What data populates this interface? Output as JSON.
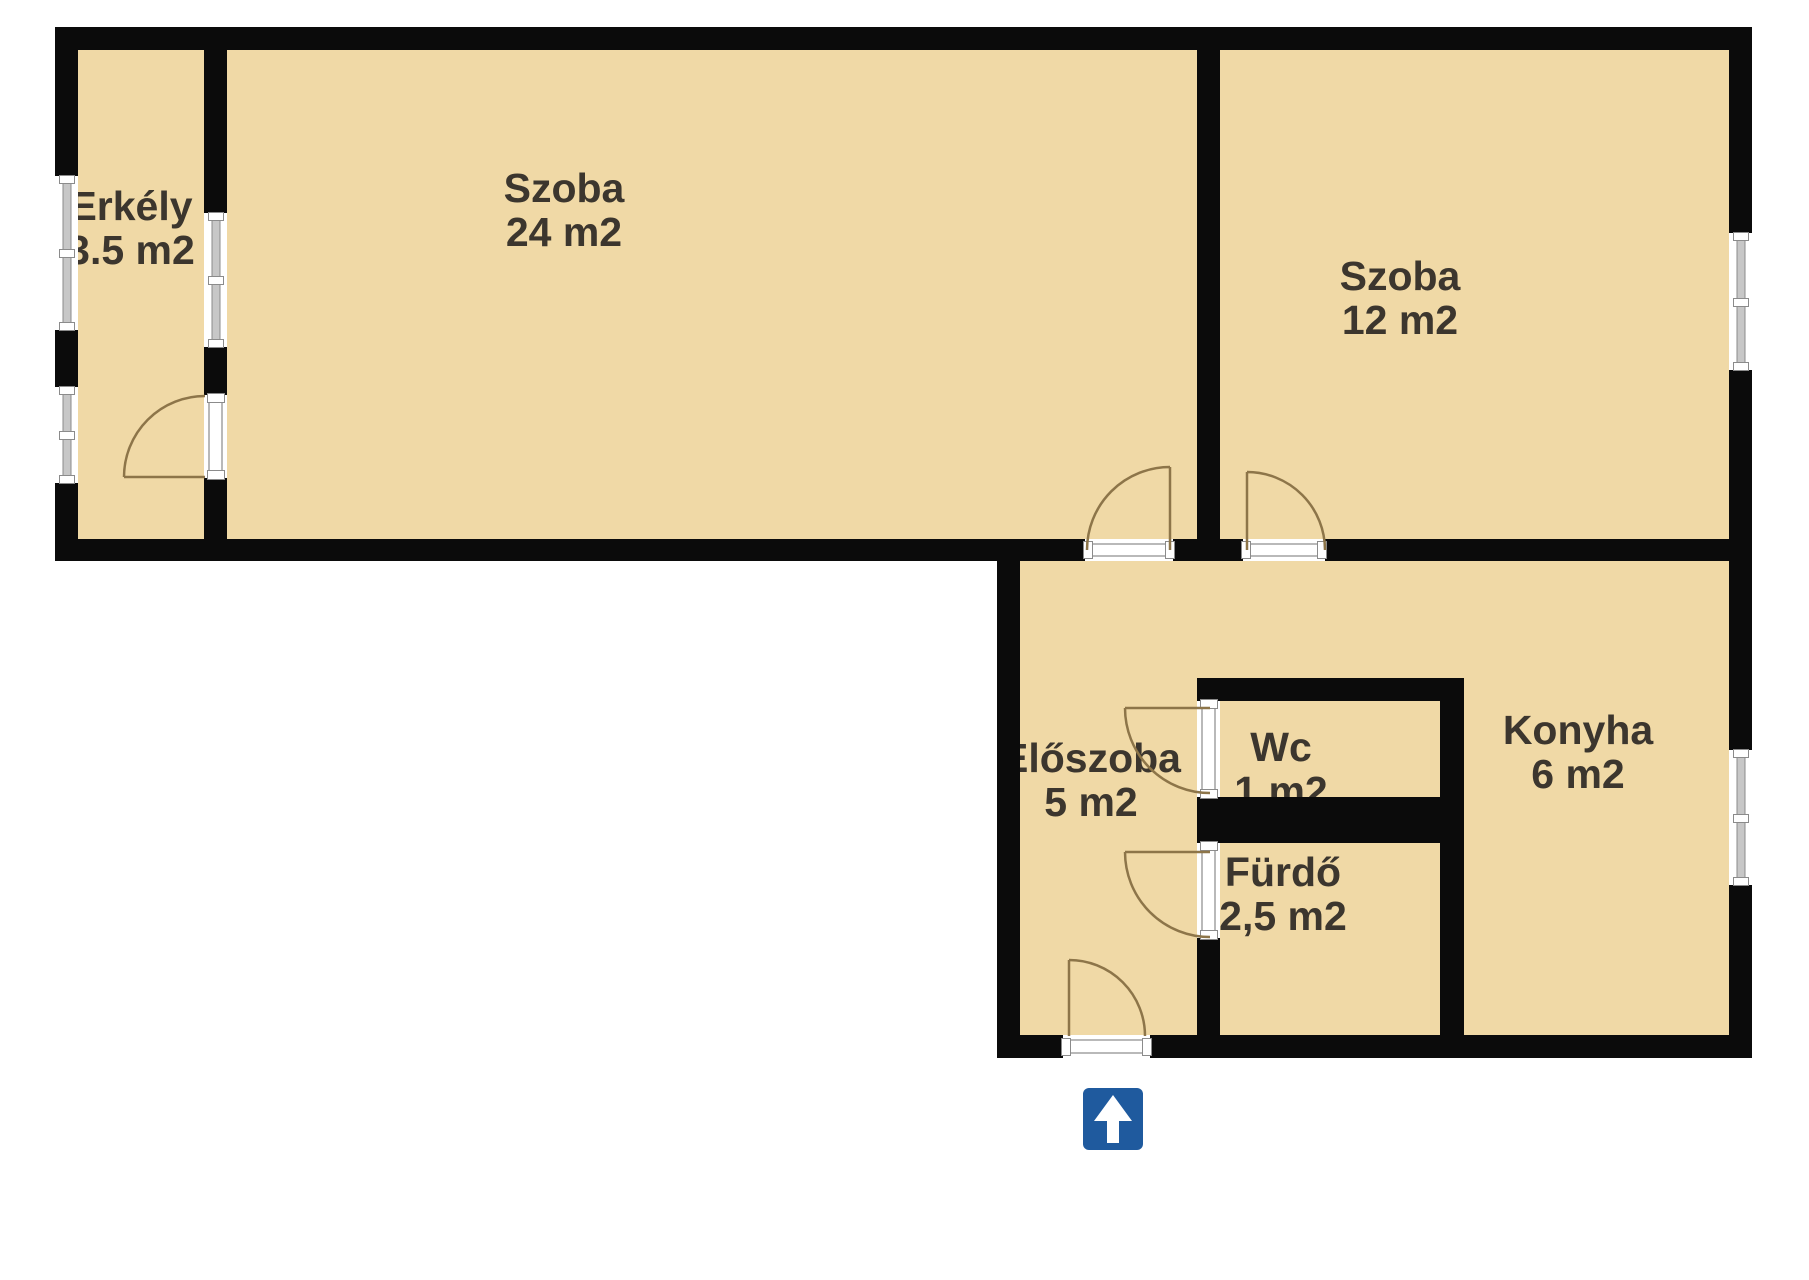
{
  "plan": {
    "title": "Apartment floor plan",
    "rooms": [
      {
        "key": "erkely",
        "label": "Erkély",
        "area": "3.5 m2"
      },
      {
        "key": "szoba-large",
        "label": "Szoba",
        "area": "24 m2"
      },
      {
        "key": "szoba-small",
        "label": "Szoba",
        "area": "12 m2"
      },
      {
        "key": "eloszoba",
        "label": "Előszoba",
        "area": "5 m2"
      },
      {
        "key": "wc",
        "label": "Wc",
        "area": "1 m2"
      },
      {
        "key": "furdo",
        "label": "Fürdő",
        "area": "2,5 m2"
      },
      {
        "key": "konyha",
        "label": "Konyha",
        "area": "6 m2"
      }
    ],
    "entrance_icon": "up-arrow",
    "colors": {
      "floor": "#f0d9a6",
      "wall": "#0b0b0b",
      "door_arc": "#8d7549",
      "window_glaze": "#c7c7c7",
      "entrance_sign": "#1f5a9e",
      "label_text": "#3c362e",
      "background": "#ffffff"
    }
  }
}
